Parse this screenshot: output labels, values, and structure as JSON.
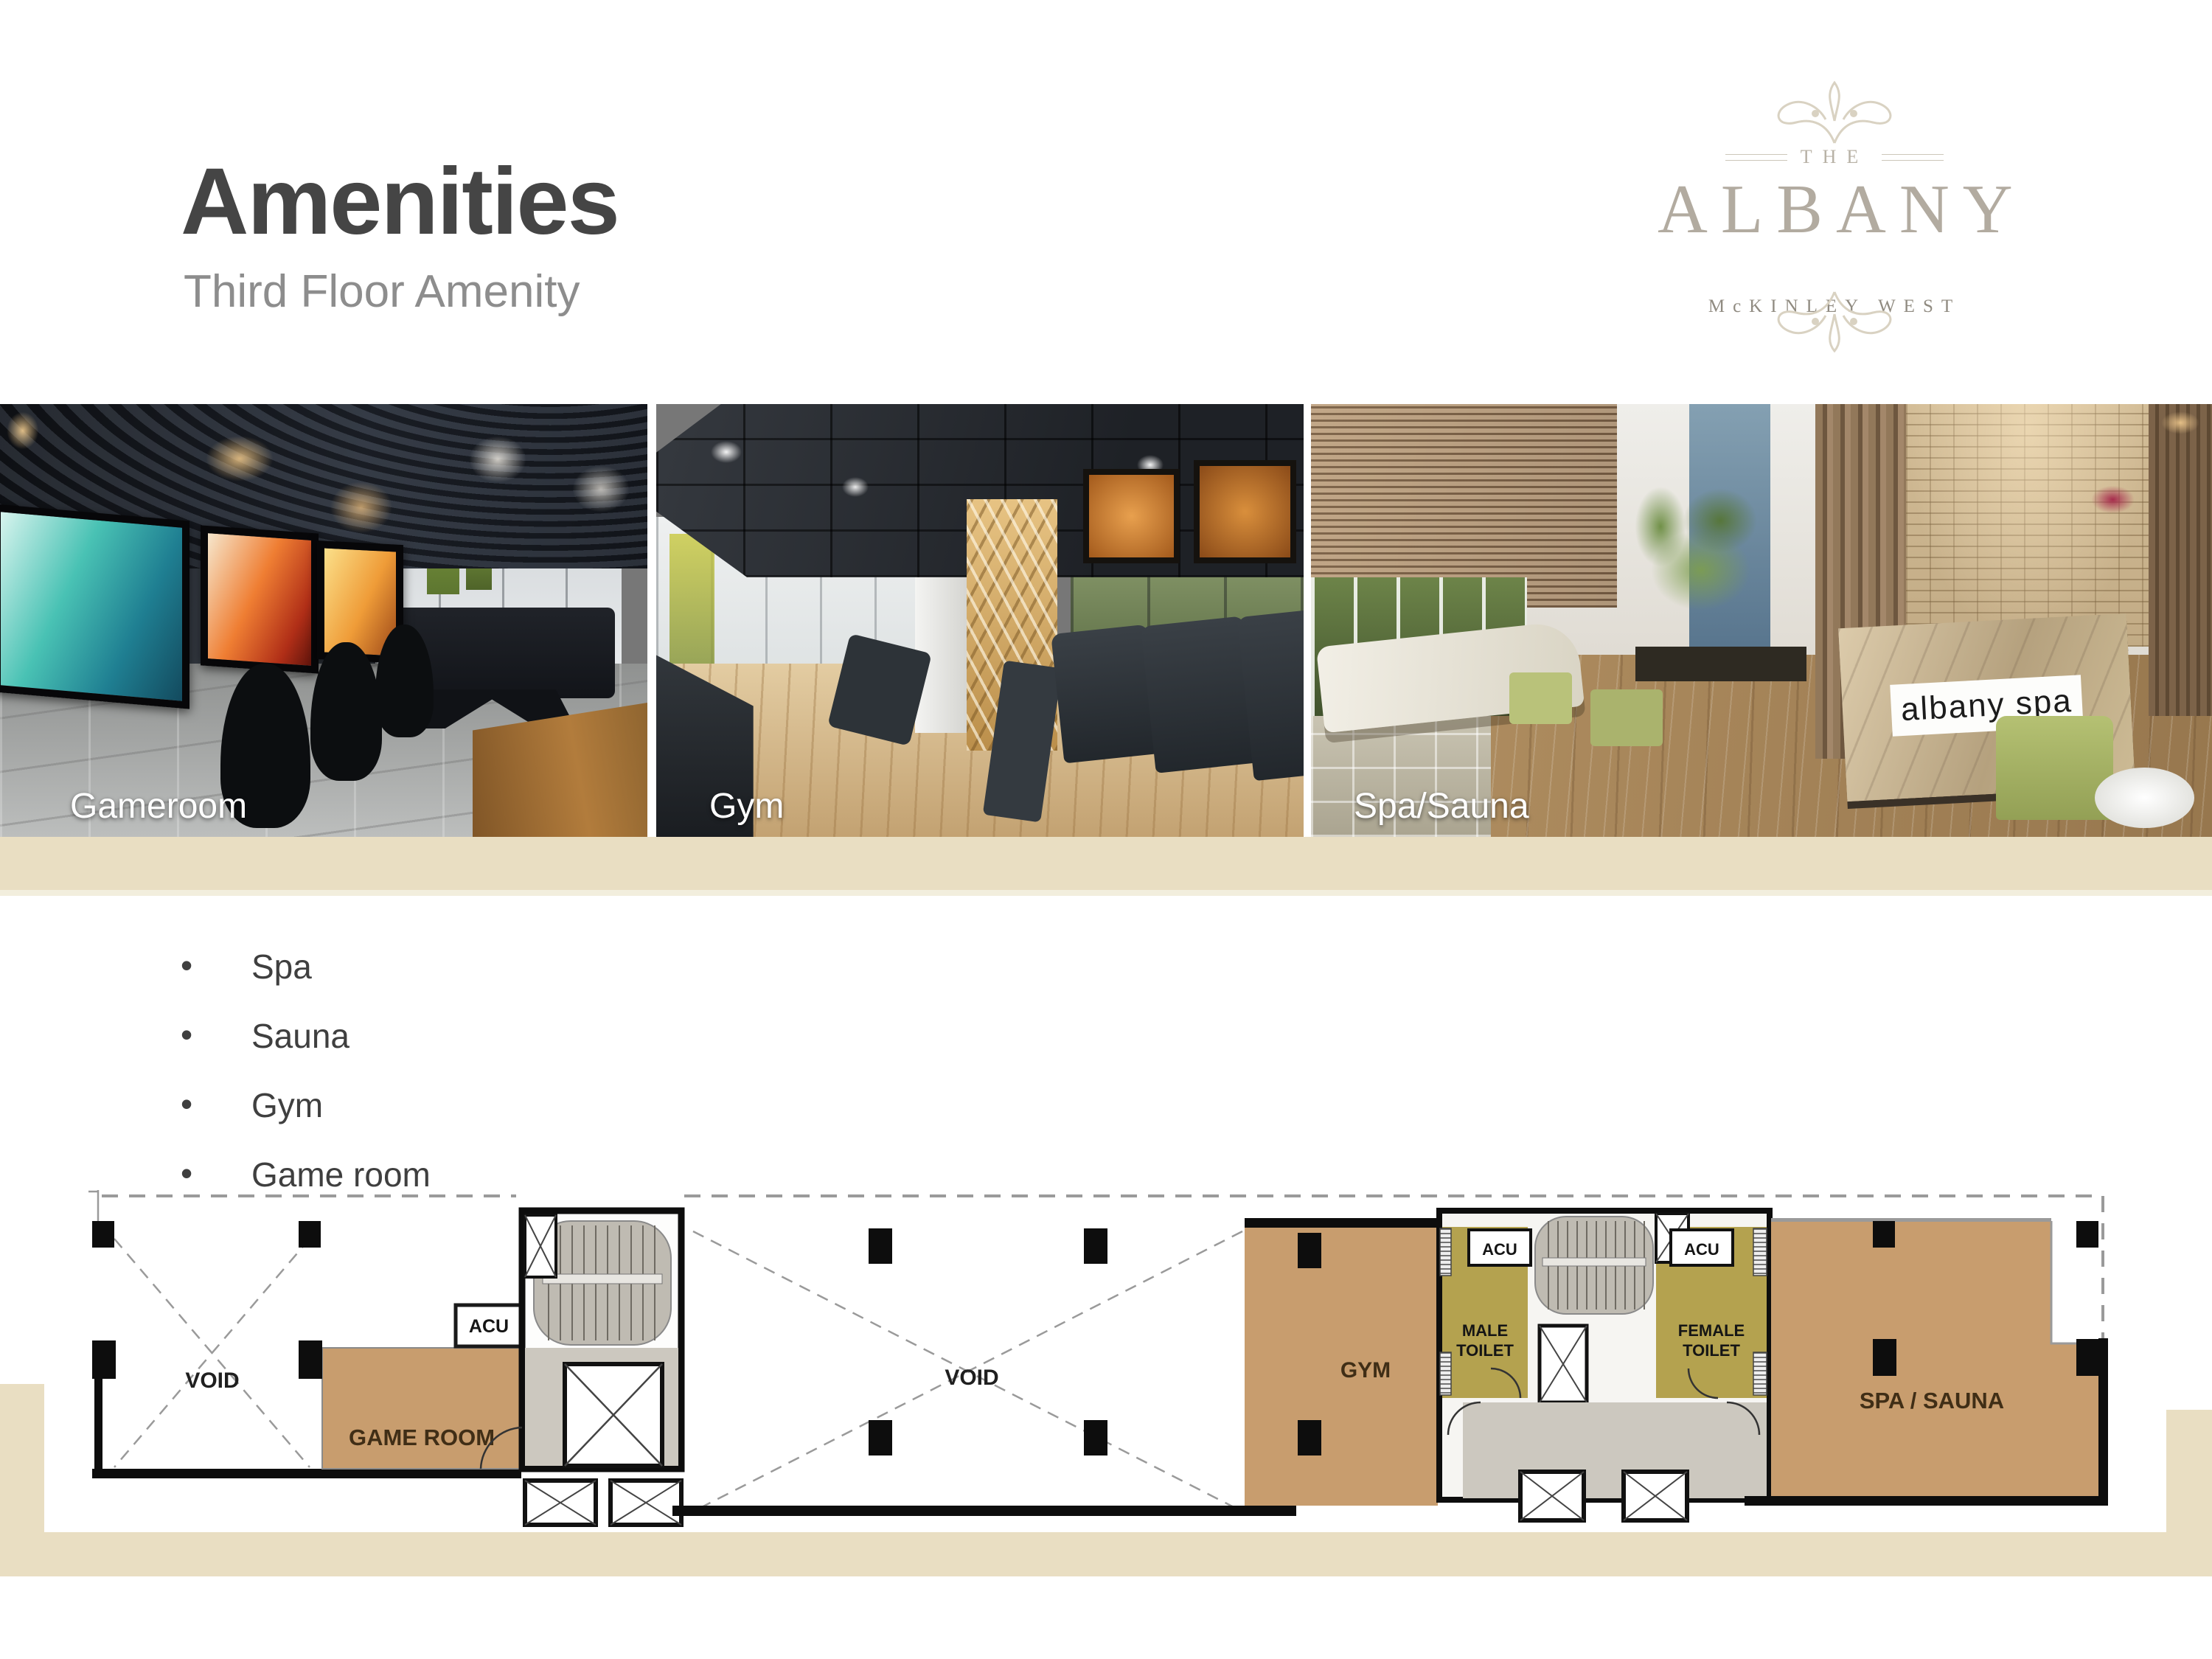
{
  "header": {
    "title": "Amenities",
    "subtitle": "Third Floor Amenity"
  },
  "logo": {
    "the": "THE",
    "name": "ALBANY",
    "tagline": "McKINLEY WEST"
  },
  "photos": {
    "items": [
      {
        "label": "Gameroom"
      },
      {
        "label": "Gym"
      },
      {
        "label": "Spa/Sauna"
      }
    ],
    "spa_sign": "albany spa"
  },
  "amenities_list": {
    "items": [
      "Spa",
      "Sauna",
      "Gym",
      "Game room"
    ]
  },
  "floor_plan": {
    "void_left": "VOID",
    "void_middle": "VOID",
    "game_room": "GAME ROOM",
    "gym": "GYM",
    "acu_left": "ACU",
    "acu_male": "ACU",
    "acu_female": "ACU",
    "male_toilet_line1": "MALE",
    "male_toilet_line2": "TOILET",
    "female_toilet_line1": "FEMALE",
    "female_toilet_line2": "TOILET",
    "spa_sauna": "SPA / SAUNA"
  },
  "colors": {
    "accent_band": "#e9dec2",
    "room_tan": "#c89d6e",
    "toilet_olive": "#b4a24f",
    "core_gray": "#ccc8bf",
    "title_gray": "#454545",
    "subtitle_gray": "#8d8d8d"
  }
}
